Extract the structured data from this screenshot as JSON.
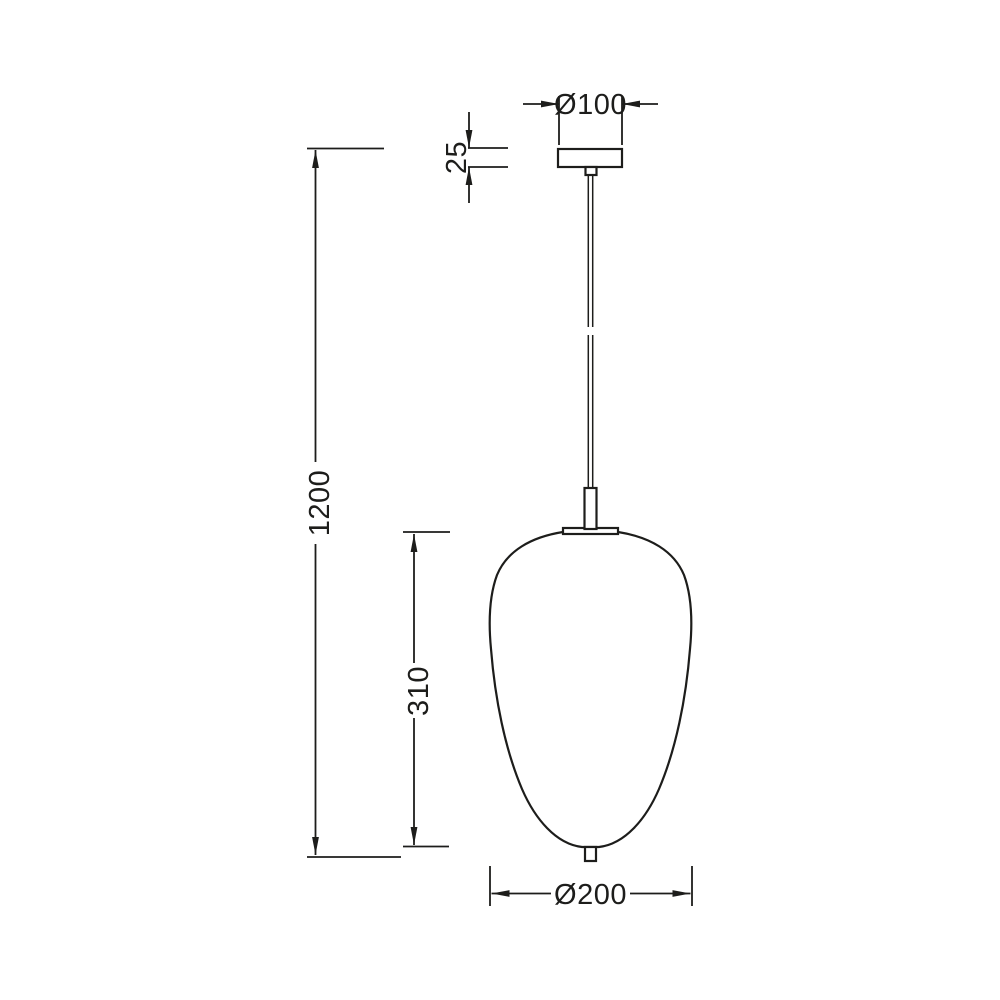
{
  "drawing": {
    "subject": "pendant lamp line drawing",
    "dimensions": {
      "canopy_diameter": "Ø100",
      "canopy_height": "25",
      "overall_height": "1200",
      "shade_height": "310",
      "shade_diameter": "Ø200"
    },
    "colors": {
      "line": "#1d1d1b",
      "background": "#ffffff"
    }
  }
}
